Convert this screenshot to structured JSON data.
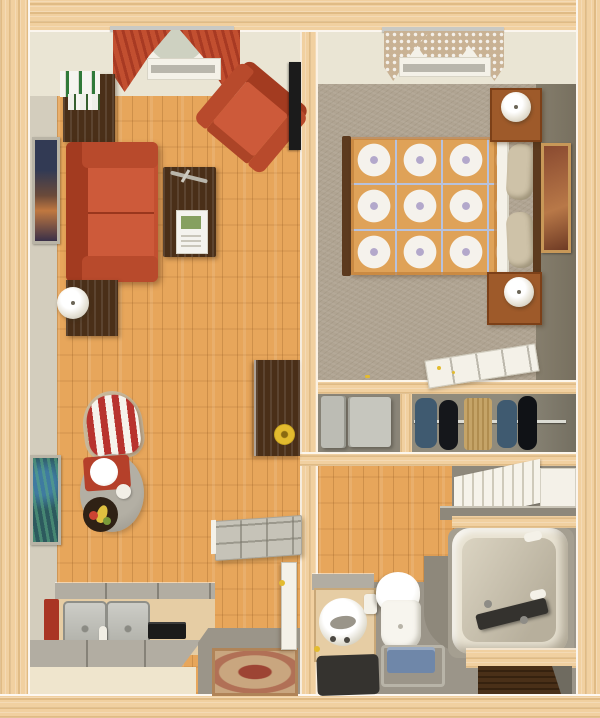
{
  "meta": {
    "description": "3D top-down architectural floor plan rendering of a one-bedroom apartment",
    "image_type": "floor-plan",
    "text_visible": "none"
  },
  "palette": {
    "wood-frame": "#f1d0a0",
    "wall-cream": "#eae5d4",
    "wall-gray": "#d3cdbd",
    "wall-olive": "#867e6d",
    "floor-wood": "#e7a65b",
    "carpet": "#b0a492",
    "red-sofa": "#c24f30",
    "red-dark": "#a33b20",
    "red-cushion": "#cd5a3a",
    "dark-wood": "#4a2f18",
    "rail-wood": "#5c3a1e",
    "nightstand-wood": "#9e5a2a",
    "quilt-orange": "#dfa258",
    "quilt-white": "#f5f2ec",
    "quilt-lavender": "#b3a8cb",
    "quilt-grid": "#b7c2de",
    "pillow-tan": "#cec2a8",
    "white-paint": "#f4f1e8",
    "silver": "#c9c9c4",
    "counter-gray": "#b2ada2",
    "cabinet-tan": "#e6cda4",
    "cabinet-cream": "#efe5cd",
    "appliance-gray": "#bcbcb4",
    "tile-gray": "#9b9589",
    "tile-dark": "#8e887b",
    "closet-floor": "#8a8578",
    "tub-cream": "#e9e3d3",
    "tub-surround": "#a59f91",
    "basin-beige": "#dbd4c2",
    "mat-dark": "#35332f",
    "stool-blue": "#6f87a9",
    "towel-red": "#a93524",
    "rug-tan": "#c9a67f",
    "rug-red": "#9d4434",
    "gold": "#e3bb2f",
    "black": "#1b1b1b",
    "stripe-red": "#b8332e",
    "valance-green": "#ced1c1",
    "curtain-tan": "#c9b294",
    "art-teal": "#2d5a5e",
    "art-navy": "#323a54",
    "art-rust": "#8a4a30"
  },
  "rooms": [
    {
      "name": "living-room",
      "floor": "hardwood",
      "items": [
        "window-with-red-swag-curtains",
        "bookshelf-with-books",
        "wall-art-sunset",
        "red-sofa",
        "end-table-with-lamp",
        "coffee-table-with-magazines",
        "red-armchair",
        "wall-mounted-tv",
        "open-dark-wood-door-with-wreath",
        "wall-drop-leaf-panel-table",
        "striped-wingback-chair",
        "round-table-with-dinner-tray",
        "fruit-bowl",
        "wall-art-teal-abstract"
      ]
    },
    {
      "name": "bedroom",
      "floor": "carpet",
      "items": [
        "window-with-lace-curtains",
        "double-bed-patchwork-quilt",
        "pillows",
        "nightstand-with-lamp-upper",
        "nightstand-with-lamp-lower",
        "wall-art-portrait",
        "open-white-door"
      ]
    },
    {
      "name": "laundry-closet",
      "floor": "vinyl",
      "items": [
        "washer",
        "dryer"
      ]
    },
    {
      "name": "wardrobe-closet",
      "floor": "vinyl",
      "items": [
        "closet-rod",
        "hanging-clothes-blue",
        "hanging-clothes-black",
        "hanging-garment-tan"
      ]
    },
    {
      "name": "bathroom",
      "floor": "tile-and-hardwood",
      "items": [
        "bifold-closet-doors",
        "bathtub-with-faucet",
        "vanity-with-round-sink",
        "toilet-paper-holder",
        "toilet",
        "blue-shower-stool",
        "dark-floor-mat",
        "wood-slat-alcove"
      ]
    },
    {
      "name": "kitchen",
      "floor": "hardwood",
      "items": [
        "l-shaped-counter",
        "double-sink",
        "faucet",
        "black-cooktop",
        "red-dish-towel"
      ]
    },
    {
      "name": "entry",
      "floor": "tile",
      "items": [
        "entry-tile",
        "oriental-door-mat",
        "open-white-entry-door"
      ]
    }
  ]
}
